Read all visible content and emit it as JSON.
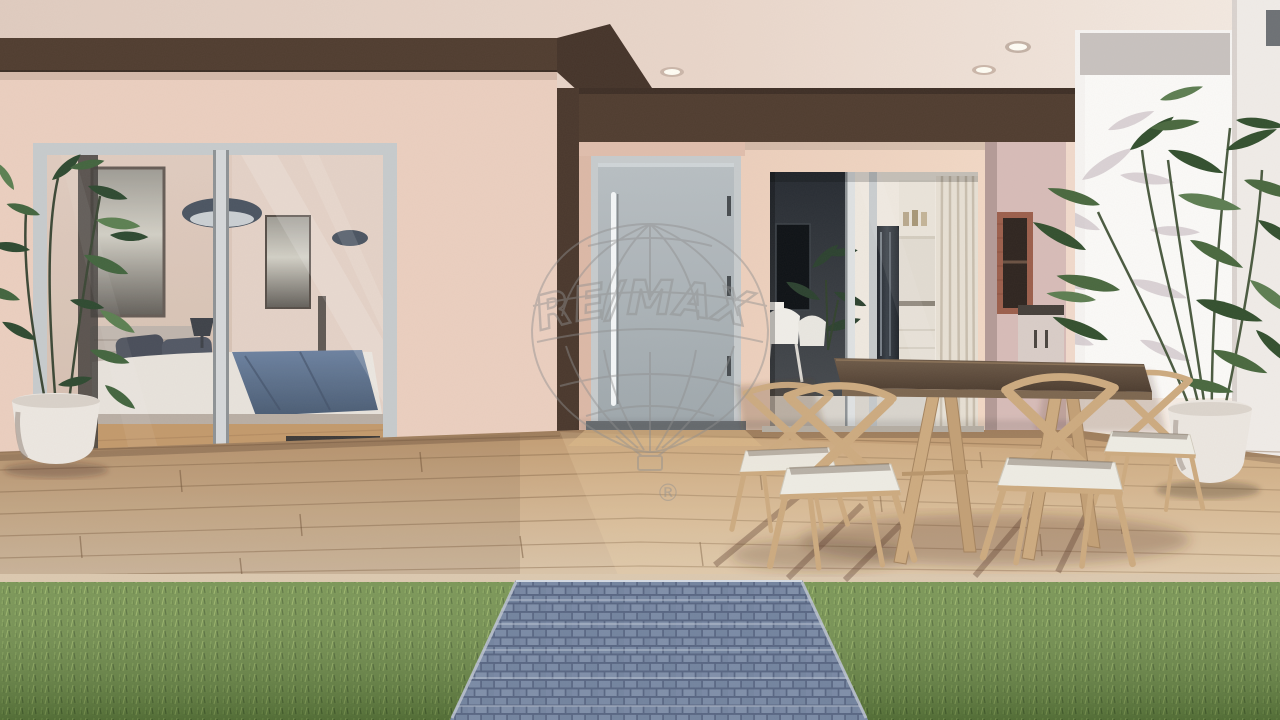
{
  "watermark": {
    "brand": "RE/MAX",
    "registered": "®"
  },
  "colors": {
    "ceiling": "#e8d5c9",
    "fascia_brown": "#503d30",
    "wall_pink": "#ebcfc0",
    "wall_pink_light": "#f0d6c4",
    "door_gray": "#aab2b7",
    "frame_silver": "#c7cbcd",
    "deck_wood": "#cdb292",
    "grass_green": "#6d8c49",
    "paver_blue": "#8294ae",
    "table_wood": "#5f4e3f",
    "chair_wood": "#cdab80",
    "cushion_white": "#eeece4",
    "white_wall": "#f6f4f2",
    "pot_white": "#ece7e1",
    "plant_green": "#3f5c3b",
    "interior_dark": "#262b31",
    "curtain_beige": "#e7e0d4",
    "brick_red": "#9c5f4c",
    "watermark_gray": "#8f8f8f"
  }
}
